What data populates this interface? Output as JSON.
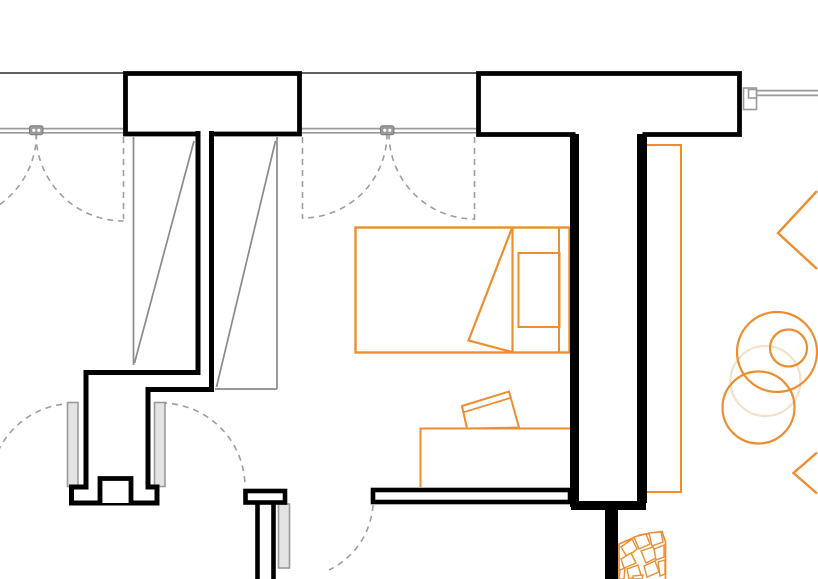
{
  "canvas": {
    "width": 818,
    "height": 579,
    "background": "#ffffff"
  },
  "palette": {
    "wall": "#000000",
    "thin": "#4a4a4a",
    "win": "#9a9a9a",
    "winDark": "#7d7d7d",
    "leafFill": "#e4e4e4",
    "dash": "#9e9e9e",
    "closet": "#8a8a8a",
    "orange": "#EC8E2F",
    "orangeLight": "#F5E0C8",
    "white": "#ffffff"
  },
  "layers": [
    {
      "name": "shell-lines",
      "elements": [
        {
          "name": "exterior-wall-face-line-left",
          "type": "line",
          "x1": 0,
          "y1": 73,
          "x2": 124,
          "y2": 73,
          "stroke": "thin",
          "w": 1.8
        },
        {
          "name": "exterior-wall-face-line-mid",
          "type": "line",
          "x1": 301,
          "y1": 73,
          "x2": 477,
          "y2": 73,
          "stroke": "thin",
          "w": 1.8
        },
        {
          "name": "window1-glazing-line-outer",
          "type": "line",
          "x1": 0,
          "y1": 128.6,
          "x2": 123,
          "y2": 128.6,
          "stroke": "win",
          "w": 1.7
        },
        {
          "name": "window1-glazing-line-inner",
          "type": "line",
          "x1": 0,
          "y1": 132.8,
          "x2": 123,
          "y2": 132.8,
          "stroke": "win",
          "w": 1.7
        },
        {
          "name": "window2-glazing-line-outer",
          "type": "line",
          "x1": 302,
          "y1": 128.6,
          "x2": 476,
          "y2": 128.6,
          "stroke": "win",
          "w": 1.7
        },
        {
          "name": "window2-glazing-line-inner",
          "type": "line",
          "x1": 302,
          "y1": 132.8,
          "x2": 476,
          "y2": 132.8,
          "stroke": "win",
          "w": 1.7
        },
        {
          "name": "window3-glazing-line-outer",
          "type": "line",
          "x1": 756,
          "y1": 90.6,
          "x2": 818,
          "y2": 90.6,
          "stroke": "win",
          "w": 1.7
        },
        {
          "name": "window3-glazing-line-inner",
          "type": "line",
          "x1": 756,
          "y1": 95.4,
          "x2": 818,
          "y2": 95.4,
          "stroke": "win",
          "w": 1.7
        }
      ]
    },
    {
      "name": "swing-symbols",
      "elements": [
        {
          "name": "window1-open-leaf-dashed-line",
          "type": "line",
          "x1": 123.5,
          "y1": 137,
          "x2": 123.5,
          "y2": 219,
          "stroke": "dash",
          "w": 1.6,
          "dash": "6 5"
        },
        {
          "name": "window1-right-sash-swing-arc",
          "type": "path",
          "d": "M 36,133.5 A 87.5 87.5 0 0 0 123.5,221",
          "stroke": "dash",
          "w": 1.6,
          "dash": "6 5"
        },
        {
          "name": "window1-left-sash-swing-arc",
          "type": "path",
          "d": "M 36.5,133.5 A 87.5 87.5 0 0 1 -1,205",
          "stroke": "dash",
          "w": 1.6,
          "dash": "6 5"
        },
        {
          "name": "window2-open-leaf-dashed-line-left",
          "type": "line",
          "x1": 302.5,
          "y1": 137,
          "x2": 302.5,
          "y2": 219,
          "stroke": "dash",
          "w": 1.6,
          "dash": "6 5"
        },
        {
          "name": "window2-open-leaf-dashed-line-right",
          "type": "line",
          "x1": 474.5,
          "y1": 137,
          "x2": 474.5,
          "y2": 221,
          "stroke": "dash",
          "w": 1.6,
          "dash": "6 5"
        },
        {
          "name": "window2-left-sash-swing-arc",
          "type": "path",
          "d": "M 387,133.5 A 84.5 84.5 0 0 1 302.5,218",
          "stroke": "dash",
          "w": 1.6,
          "dash": "6 5"
        },
        {
          "name": "window2-right-sash-swing-arc",
          "type": "path",
          "d": "M 389,133.5 A 85.5 85.5 0 0 0 474.5,219",
          "stroke": "dash",
          "w": 1.6,
          "dash": "6 5"
        },
        {
          "name": "hall-door-left-swing-arc",
          "type": "path",
          "d": "M 73,403.5 A 83.5 83.5 0 0 0 -10,487",
          "stroke": "dash",
          "w": 1.6,
          "dash": "6 5"
        },
        {
          "name": "hall-door-right-swing-arc",
          "type": "path",
          "d": "M 161,403 A 84 84 0 0 1 245,487",
          "stroke": "dash",
          "w": 1.6,
          "dash": "6 5"
        },
        {
          "name": "bottom-door-swing-arc",
          "type": "path",
          "d": "M 373,505 A 78 78 0 0 1 329,570",
          "stroke": "dash",
          "w": 1.6,
          "dash": "6 5"
        }
      ]
    },
    {
      "name": "closet-symbols",
      "elements": [
        {
          "name": "closet-left-side-line",
          "type": "line",
          "x1": 133.5,
          "y1": 137,
          "x2": 133.5,
          "y2": 365,
          "stroke": "closet",
          "w": 1.7
        },
        {
          "name": "closet-left-door-diagonal",
          "type": "line",
          "x1": 194,
          "y1": 141,
          "x2": 134.5,
          "y2": 363,
          "stroke": "closet",
          "w": 1.7
        },
        {
          "name": "closet-right-side-line",
          "type": "line",
          "x1": 277,
          "y1": 137,
          "x2": 277,
          "y2": 389,
          "stroke": "closet",
          "w": 1.7
        },
        {
          "name": "closet-right-bottom-line",
          "type": "line",
          "x1": 215,
          "y1": 389,
          "x2": 277,
          "y2": 389,
          "stroke": "closet",
          "w": 1.7
        },
        {
          "name": "closet-right-door-diagonal",
          "type": "line",
          "x1": 275.5,
          "y1": 141,
          "x2": 216.5,
          "y2": 387,
          "stroke": "closet",
          "w": 1.7
        }
      ]
    },
    {
      "name": "door-leaves",
      "elements": [
        {
          "name": "hall-door-left-leaf",
          "type": "rect",
          "x": 67.5,
          "y": 402.5,
          "wd": 10.5,
          "h": 84,
          "stroke": "win",
          "w": 1.6,
          "fill": "leafFill"
        },
        {
          "name": "hall-door-right-leaf",
          "type": "rect",
          "x": 154.5,
          "y": 402.5,
          "wd": 10.5,
          "h": 84,
          "stroke": "win",
          "w": 1.6,
          "fill": "leafFill"
        },
        {
          "name": "bottom-door-leaf",
          "type": "rect",
          "x": 278.5,
          "y": 504,
          "wd": 11,
          "h": 64,
          "stroke": "win",
          "w": 1.6,
          "fill": "leafFill"
        }
      ]
    },
    {
      "name": "window-hardware",
      "elements": [
        {
          "name": "window1-hinge-connector",
          "type": "rect",
          "x": 29.5,
          "y": 125.8,
          "wd": 13.5,
          "h": 9,
          "rx": 2,
          "stroke": "winDark",
          "w": 1,
          "fill": "win"
        },
        {
          "name": "window1-hinge-dot-left",
          "type": "circle",
          "cx": 33.8,
          "cy": 130.3,
          "r": 1.6,
          "fill": "white",
          "stroke": "none",
          "w": 0
        },
        {
          "name": "window1-hinge-dot-right",
          "type": "circle",
          "cx": 38.8,
          "cy": 130.3,
          "r": 1.6,
          "fill": "white",
          "stroke": "none",
          "w": 0
        },
        {
          "name": "window2-hinge-connector",
          "type": "rect",
          "x": 380.5,
          "y": 125.8,
          "wd": 13.5,
          "h": 9,
          "rx": 2,
          "stroke": "winDark",
          "w": 1,
          "fill": "win"
        },
        {
          "name": "window2-hinge-dot-left",
          "type": "circle",
          "cx": 384.8,
          "cy": 130.3,
          "r": 1.6,
          "fill": "white",
          "stroke": "none",
          "w": 0
        },
        {
          "name": "window2-hinge-dot-right",
          "type": "circle",
          "cx": 389.8,
          "cy": 130.3,
          "r": 1.6,
          "fill": "white",
          "stroke": "none",
          "w": 0
        },
        {
          "name": "window3-end-connector-outer",
          "type": "rect",
          "x": 743.5,
          "y": 88,
          "wd": 13,
          "h": 21.5,
          "stroke": "win",
          "w": 1.6,
          "fill": "white"
        },
        {
          "name": "window3-end-connector-tab",
          "type": "rect",
          "x": 748.5,
          "y": 89.5,
          "wd": 8,
          "h": 8.5,
          "stroke": "win",
          "w": 1.6,
          "fill": "white"
        }
      ]
    },
    {
      "name": "furniture",
      "elements": [
        {
          "name": "side-table-faint-circle",
          "type": "circle",
          "cx": 765.5,
          "cy": 381,
          "r": 35,
          "stroke": "orangeLight",
          "w": 2.2,
          "fill": "none"
        },
        {
          "name": "bed-outline",
          "type": "rect",
          "x": 355.5,
          "y": 227.5,
          "wd": 214,
          "h": 125,
          "stroke": "orange",
          "w": 2.4,
          "fill": "none"
        },
        {
          "name": "bed-headboard-divider-line",
          "type": "line",
          "x1": 512.5,
          "y1": 227.5,
          "x2": 512.5,
          "y2": 352.5,
          "stroke": "orange",
          "w": 2.2
        },
        {
          "name": "bed-head-frame-line",
          "type": "line",
          "x1": 559,
          "y1": 227.5,
          "x2": 559,
          "y2": 352.5,
          "stroke": "orange",
          "w": 2
        },
        {
          "name": "bed-pillow",
          "type": "rect",
          "x": 518.5,
          "y": 253,
          "wd": 41,
          "h": 74,
          "stroke": "orange",
          "w": 2,
          "fill": "none"
        },
        {
          "name": "bed-blanket-fold",
          "type": "path",
          "d": "M 512,228 L 468.5,340.5 L 512,352",
          "stroke": "orange",
          "w": 2.2,
          "fill": "none"
        },
        {
          "name": "desk-outline",
          "type": "path",
          "d": "M 420.5,487 L 420.5,428.5 L 572,428.5",
          "stroke": "orange",
          "w": 2,
          "fill": "none"
        },
        {
          "name": "desk-chair-seat",
          "type": "polygon",
          "pts": "462,406 509,391.5 519,427.5 467,428.5",
          "stroke": "orange",
          "w": 2,
          "fill": "none"
        },
        {
          "name": "desk-chair-backrest-line",
          "type": "line",
          "x1": 463.8,
          "y1": 412.2,
          "x2": 510.8,
          "y2": 397.7,
          "stroke": "orange",
          "w": 1.8
        },
        {
          "name": "wardrobe-tall-cabinet",
          "type": "rect",
          "x": 641,
          "y": 145,
          "wd": 40,
          "h": 347,
          "stroke": "orange",
          "w": 2,
          "fill": "none"
        },
        {
          "name": "armchair-circle-large",
          "type": "circle",
          "cx": 777,
          "cy": 352,
          "r": 40,
          "stroke": "orange",
          "w": 2.2,
          "fill": "none"
        },
        {
          "name": "armchair-circle-inner",
          "type": "circle",
          "cx": 788.5,
          "cy": 348,
          "r": 18.5,
          "stroke": "orange",
          "w": 2.2,
          "fill": "none"
        },
        {
          "name": "armchair-circle-lower",
          "type": "circle",
          "cx": 758.5,
          "cy": 407.5,
          "r": 36,
          "stroke": "orange",
          "w": 2.2,
          "fill": "none"
        },
        {
          "name": "decor-diamond-top-right",
          "type": "path",
          "d": "M 817,191 L 778,233 L 817,269",
          "stroke": "orange",
          "w": 2.4,
          "fill": "none"
        },
        {
          "name": "decor-diamond-bottom-right",
          "type": "path",
          "d": "M 817,452.5 L 793.5,473 L 817,493.5",
          "stroke": "orange",
          "w": 2.4,
          "fill": "none"
        }
      ]
    },
    {
      "name": "walls",
      "elements": [
        {
          "name": "wall-pier-left",
          "type": "path",
          "d": "M 199,134 L 125.5,134 L 125.5,73.5 L 299.5,73.5 L 299.5,134 L 211.5,134",
          "stroke": "wall",
          "w": 4.8,
          "fill": "white"
        },
        {
          "name": "wall-pier-top-right",
          "type": "path",
          "d": "M 575.5,134.5 L 478.5,134.5 L 478.5,73.5 L 739.5,73.5 L 739.5,134.5 L 642.5,134.5",
          "stroke": "wall",
          "w": 4.8,
          "fill": "white"
        },
        {
          "name": "wall-left-stepped-partition",
          "type": "path",
          "d": "M 198,131 L 198,372.5 L 86,372.5 L 86,487 L 71.5,487 L 71.5,503 L 157,503 L 157,487 L 148,487 L 148,389.5 L 211.5,389.5 L 211.5,131",
          "stroke": "wall",
          "w": 5,
          "fill": "none"
        },
        {
          "name": "wall-threshold-mullion-tooth",
          "type": "path",
          "d": "M 100,503 L 100,478.5 L 131,478.5 L 131,503",
          "stroke": "wall",
          "w": 4.8,
          "fill": "white"
        },
        {
          "name": "wall-shaft-left",
          "type": "line",
          "x1": 574.5,
          "y1": 134,
          "x2": 574.5,
          "y2": 507,
          "stroke": "wall",
          "w": 9
        },
        {
          "name": "wall-shaft-right",
          "type": "line",
          "x1": 642,
          "y1": 134,
          "x2": 642,
          "y2": 503,
          "stroke": "wall",
          "w": 10
        },
        {
          "name": "wall-shaft-bottom-connector",
          "type": "line",
          "x1": 571,
          "y1": 505.5,
          "x2": 646,
          "y2": 505.5,
          "stroke": "wall",
          "w": 9
        },
        {
          "name": "wall-bottom-stem",
          "type": "line",
          "x1": 611.5,
          "y1": 503,
          "x2": 611.5,
          "y2": 579,
          "stroke": "wall",
          "w": 13
        },
        {
          "name": "wall-bottom-bar",
          "type": "rect",
          "x": 373,
          "y": 490,
          "wd": 197,
          "h": 12,
          "stroke": "wall",
          "w": 4.6,
          "fill": "white"
        },
        {
          "name": "wall-pier-bottom-cap",
          "type": "rect",
          "x": 245.5,
          "y": 491,
          "wd": 39.5,
          "h": 11.5,
          "stroke": "wall",
          "w": 4.6,
          "fill": "white"
        },
        {
          "name": "wall-pier-bottom-stem-left-line",
          "type": "line",
          "x1": 257.5,
          "y1": 503,
          "x2": 257.5,
          "y2": 579,
          "stroke": "wall",
          "w": 4.6
        },
        {
          "name": "wall-pier-bottom-stem-right-line",
          "type": "line",
          "x1": 273.5,
          "y1": 503,
          "x2": 273.5,
          "y2": 579,
          "stroke": "wall",
          "w": 4.6
        }
      ]
    },
    {
      "name": "floor-mosaic",
      "elements": [
        {
          "name": "mosaic-boundary",
          "type": "path",
          "d": "M 619,579 L 619,544 L 640,535 L 662,531.5 L 665.5,542 L 665.5,579",
          "stroke": "orange",
          "w": 1.7,
          "fill": "none"
        },
        {
          "name": "mosaic-shard",
          "type": "polygon",
          "pts": "621,547 632,539 637,549 627,557",
          "stroke": "orange",
          "w": 1.4,
          "fill": "white"
        },
        {
          "name": "mosaic-shard",
          "type": "polygon",
          "pts": "634,537 646,534 650,544 639,549",
          "stroke": "orange",
          "w": 1.4,
          "fill": "white"
        },
        {
          "name": "mosaic-shard",
          "type": "polygon",
          "pts": "649,533 661,532 663,542 652,546",
          "stroke": "orange",
          "w": 1.4,
          "fill": "white"
        },
        {
          "name": "mosaic-shard",
          "type": "polygon",
          "pts": "641,551 653,547 658,557 646,563",
          "stroke": "orange",
          "w": 1.4,
          "fill": "white"
        },
        {
          "name": "mosaic-shard",
          "type": "polygon",
          "pts": "621,559 631,553 636,563 624,568",
          "stroke": "orange",
          "w": 1.4,
          "fill": "white"
        },
        {
          "name": "mosaic-shard",
          "type": "polygon",
          "pts": "654,549 664,545 664,557 656,560",
          "stroke": "orange",
          "w": 1.4,
          "fill": "white"
        },
        {
          "name": "mosaic-shard",
          "type": "polygon",
          "pts": "627,569 638,565 641,575 629,579",
          "stroke": "orange",
          "w": 1.4,
          "fill": "white"
        },
        {
          "name": "mosaic-shard",
          "type": "polygon",
          "pts": "644,566 655,561 659,572 647,577",
          "stroke": "orange",
          "w": 1.4,
          "fill": "white"
        },
        {
          "name": "mosaic-shard",
          "type": "polygon",
          "pts": "658,562 665,560 665,574 660,576",
          "stroke": "orange",
          "w": 1.4,
          "fill": "white"
        },
        {
          "name": "mosaic-shard",
          "type": "polygon",
          "pts": "620,570 625,568 624,579 619,579",
          "stroke": "orange",
          "w": 1.4,
          "fill": "white"
        },
        {
          "name": "mosaic-shard",
          "type": "polygon",
          "pts": "633,576 643,575 642,579 633,579",
          "stroke": "orange",
          "w": 1.4,
          "fill": "white"
        }
      ]
    }
  ]
}
